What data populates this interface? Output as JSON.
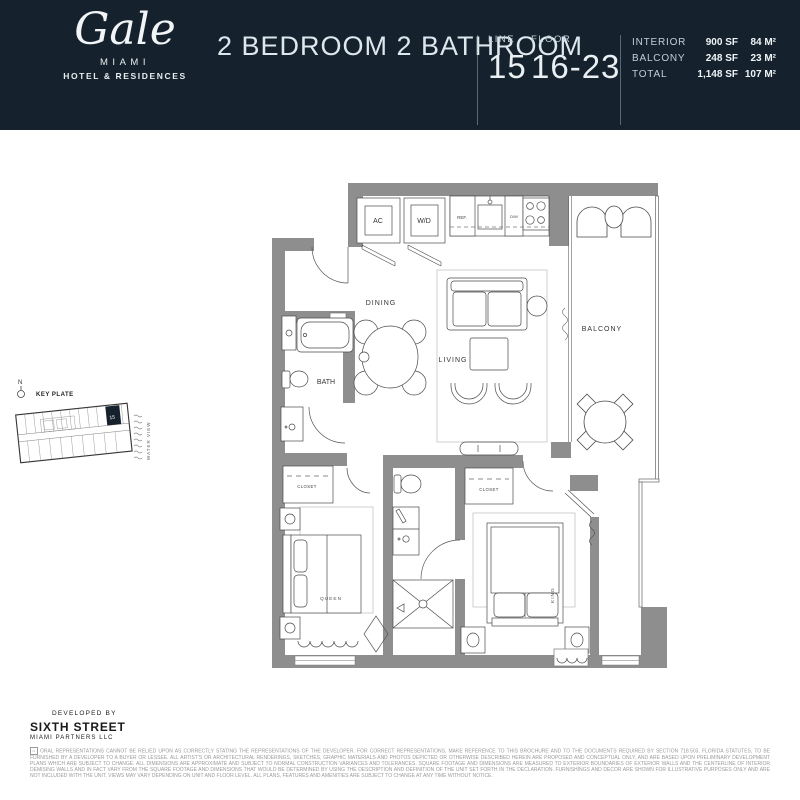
{
  "header": {
    "logo": {
      "name": "Gale",
      "city": "MIAMI",
      "sub": "HOTEL & RESIDENCES"
    },
    "title": "2 BEDROOM 2 BATHROOM",
    "line": {
      "label": "LINE",
      "value": "15"
    },
    "floor": {
      "label": "FLOOR",
      "value": "16-23"
    },
    "stats": [
      {
        "label": "INTERIOR",
        "sf": "900 SF",
        "m2": "84 M²"
      },
      {
        "label": "BALCONY",
        "sf": "248 SF",
        "m2": "23 M²"
      },
      {
        "label": "TOTAL",
        "sf": "1,148 SF",
        "m2": "107 M²"
      }
    ]
  },
  "key_plate": {
    "compass": "N",
    "label": "KEY PLATE",
    "water_view": "WATER VIEW",
    "unit": "15"
  },
  "floor_plan": {
    "labels": {
      "ac": "AC",
      "wd": "W/D",
      "ref": "REF.",
      "dw": "D/W",
      "dining": "DINING",
      "living": "LIVING",
      "bath": "BATH",
      "balcony": "BALCONY",
      "closet_queen": "CLOSET",
      "closet_king": "CLOSET",
      "queen": "QUEEN",
      "king": "KING"
    }
  },
  "footer": {
    "developed_by": "DEVELOPED BY",
    "developer": "SIXTH STREET",
    "developer_sub": "MIAMI PARTNERS LLC",
    "disclaimer": "ORAL REPRESENTATIONS CANNOT BE RELIED UPON AS CORRECTLY STATING THE REPRESENTATIONS OF THE DEVELOPER. FOR CORRECT REPRESENTATIONS, MAKE REFERENCE TO THIS BROCHURE AND TO THE DOCUMENTS REQUIRED BY SECTION 718.503, FLORIDA STATUTES, TO BE FURNISHED BY A DEVELOPER TO A BUYER OR LESSEE. ALL ARTIST'S OR ARCHITECTURAL RENDERINGS, SKETCHES, GRAPHIC MATERIALS AND PHOTOS DEPICTED OR OTHERWISE DESCRIBED HEREIN ARE PROPOSED AND CONCEPTUAL ONLY, AND ARE BASED UPON PRELIMINARY DEVELOPMENT PLANS WHICH ARE SUBJECT TO CHANGE. ALL DIMENSIONS ARE APPROXIMATE AND SUBJECT TO NORMAL CONSTRUCTION VARIANCES AND TOLERANCES. SQUARE FOOTAGE AND DIMENSIONS ARE MEASURED TO EXTERIOR BOUNDARIES OF EXTERIOR WALLS AND THE CENTERLINE OF INTERIOR DEMISING WALLS AND IN FACT VARY FROM THE SQUARE FOOTAGE AND DIMENSIONS THAT WOULD BE DETERMINED BY USING THE DESCRIPTION AND DEFINITION OF THE UNIT SET FORTH IN THE DECLARATION. FURNISHINGS AND DECOR ARE SHOWN FOR ILLUSTRATIVE PURPOSES ONLY AND ARE NOT INCLUDED WITH THE UNIT. VIEWS MAY VARY DEPENDING ON UNIT AND FLOOR LEVEL. ALL PLANS, FEATURES AND AMENITIES ARE SUBJECT TO CHANGE AT ANY TIME WITHOUT NOTICE."
  },
  "colors": {
    "header_bg": "#15222d",
    "wall_gray": "#8e8e8e",
    "line_dark": "#4a4a4a",
    "text_light": "#dde7ed"
  }
}
